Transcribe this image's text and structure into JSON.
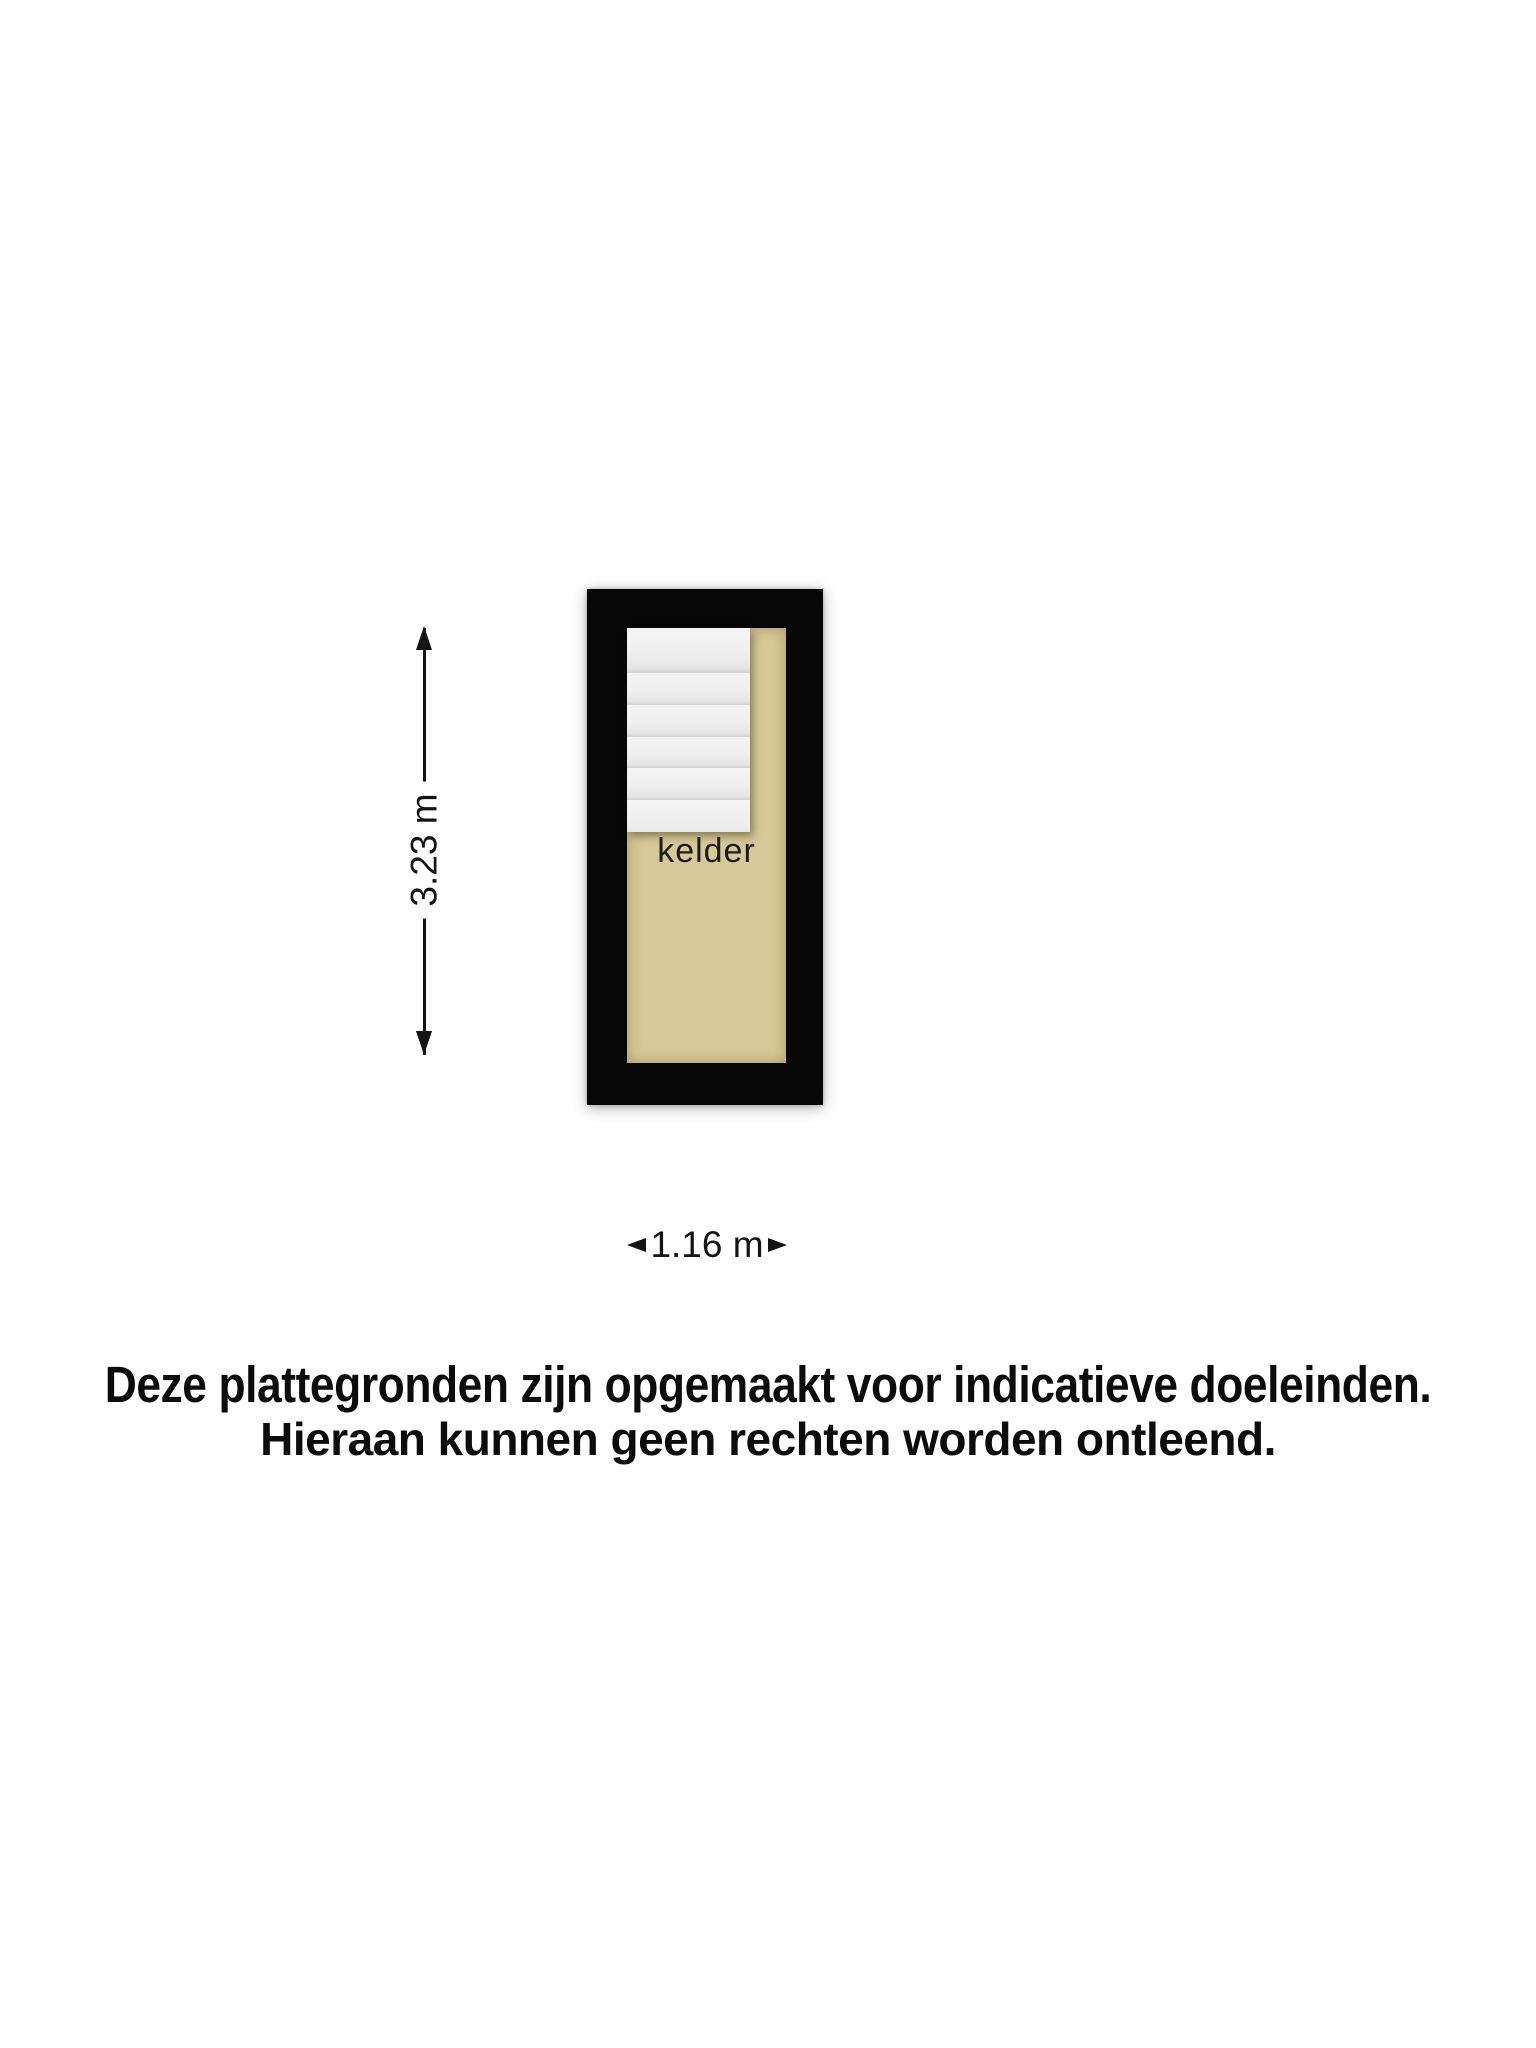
{
  "floorplan": {
    "room_label": "kelder",
    "height_label": "3.23 m",
    "width_label": "1.16 m",
    "stairs_step_count": 6
  },
  "disclaimer": {
    "line1": "Deze plattegronden zijn opgemaakt voor indicatieve doeleinden.",
    "line2": "Hieraan kunnen geen rechten worden ontleend."
  },
  "colors": {
    "background": "#ffffff",
    "wall": "#070707",
    "floor": "#d6c897",
    "stairs": "#f0f0f0",
    "text": "#111111"
  },
  "icons": {
    "arrow_up": "css-triangle-up",
    "arrow_down": "css-triangle-down",
    "arrow_left": "css-triangle-left",
    "arrow_right": "css-triangle-right"
  }
}
